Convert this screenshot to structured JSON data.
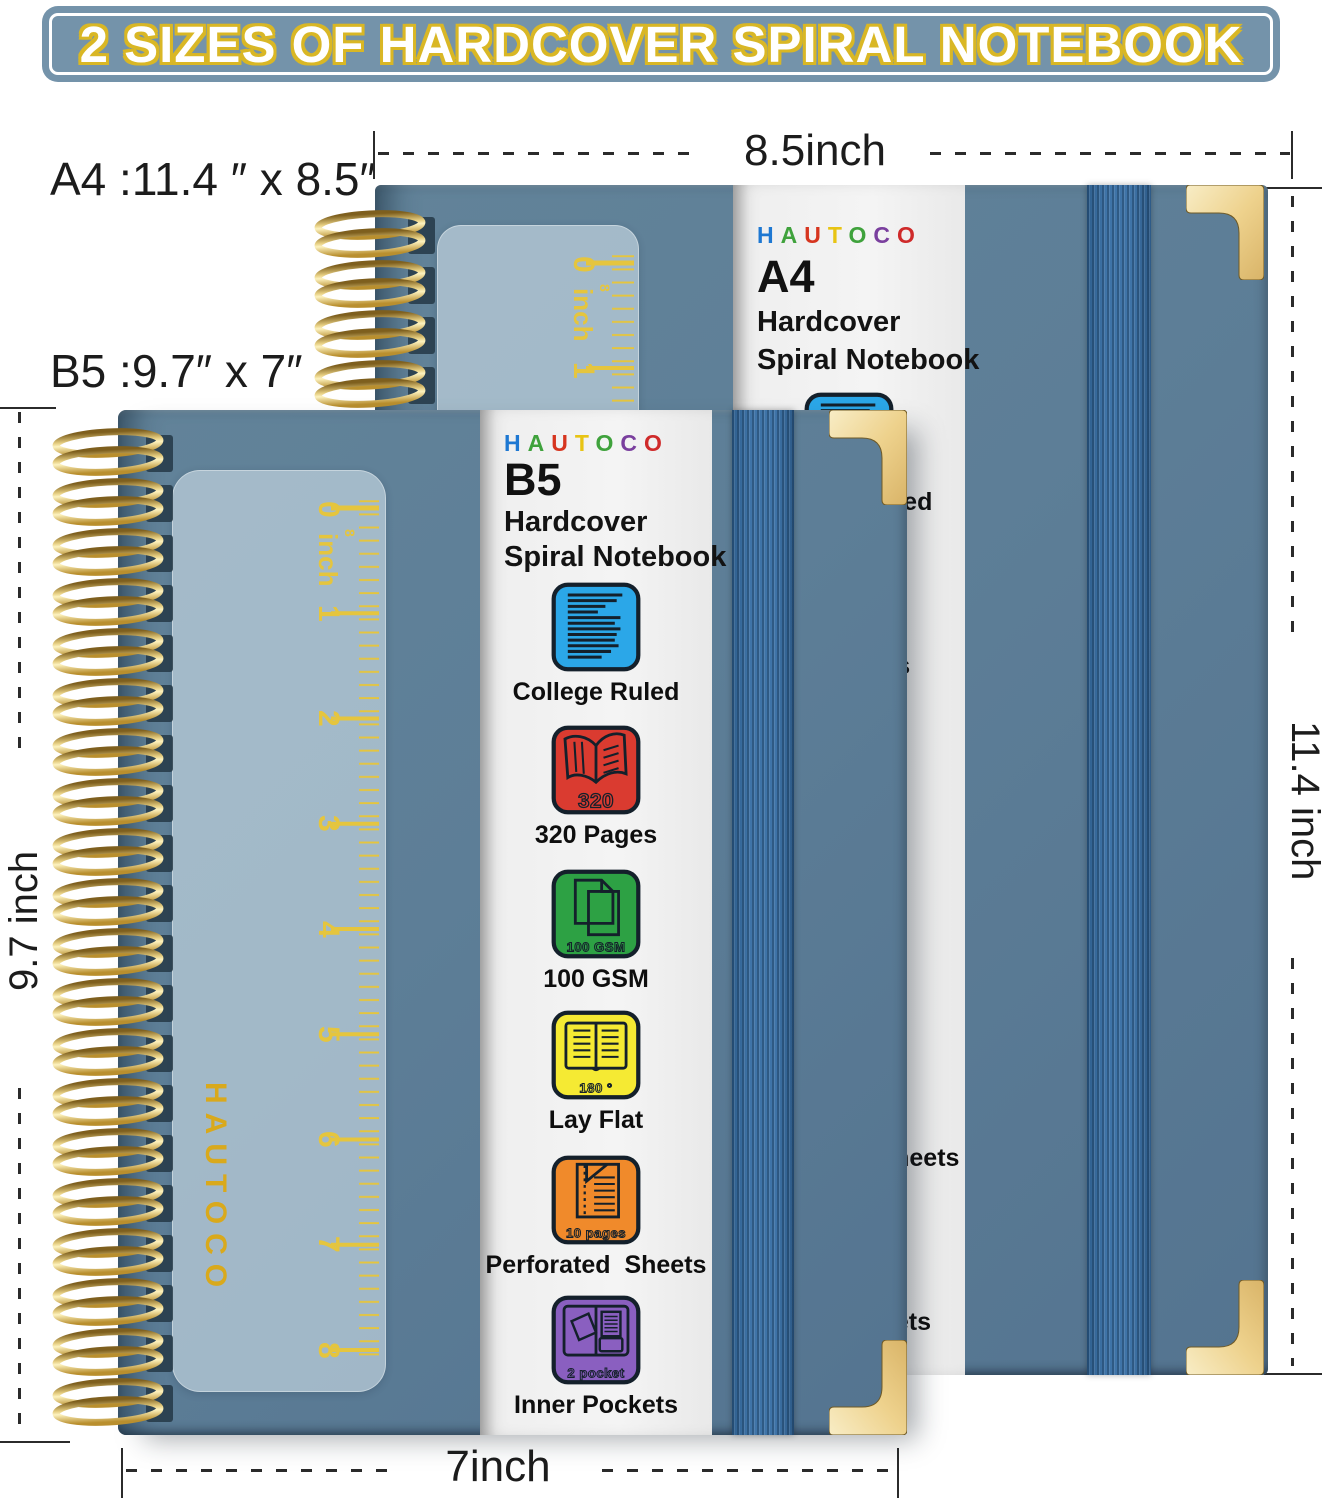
{
  "banner": {
    "title": "2 SIZES OF HARDCOVER SPIRAL NOTEBOOK"
  },
  "dims": {
    "a4_size_label": "A4 :11.4 ″ x 8.5″",
    "b5_size_label": "B5 :9.7″ x 7″",
    "top_width": "8.5inch",
    "right_height": "11.4 inch",
    "left_height": "9.7 inch",
    "bottom_width": "7inch"
  },
  "brand": {
    "name": "HAUTOCO",
    "cover_vertical": "HAUTOCO",
    "letters": [
      {
        "ch": "H",
        "style": "color:#1e78d2"
      },
      {
        "ch": "A",
        "style": "color:#3fa23c"
      },
      {
        "ch": "U",
        "style": "color:#d6351f"
      },
      {
        "ch": "T",
        "style": "color:#e8c414"
      },
      {
        "ch": "O",
        "style": "color:#3fa23c"
      },
      {
        "ch": "C",
        "style": "color:#7a3f9e"
      },
      {
        "ch": "O",
        "style": "color:#cf2a2a"
      }
    ]
  },
  "a4": {
    "size": "A4",
    "line1": "Hardcover",
    "line2": "Spiral Notebook"
  },
  "b5": {
    "size": "B5",
    "line1": "Hardcover",
    "line2": "Spiral Notebook"
  },
  "features": [
    {
      "caption": "College Ruled",
      "color": "#2ba7e8",
      "badge": ""
    },
    {
      "caption": "320 Pages",
      "color": "#da3b30",
      "badge": "320"
    },
    {
      "caption": "100 GSM",
      "color": "#2da144",
      "badge": "100 GSM"
    },
    {
      "caption": "Lay Flat",
      "color": "#f5ea33",
      "badge": "180 °"
    },
    {
      "caption": "Perforated  Sheets",
      "color": "#f08a2b",
      "badge": "10 pages"
    },
    {
      "caption": "Inner Pockets",
      "color": "#8a5fc0",
      "badge": "2 pocket"
    }
  ],
  "ruler": {
    "unit": "inch",
    "scale_mark": "8",
    "a4_marks": [
      "0",
      "1"
    ],
    "b5_marks": [
      "0",
      "1",
      "2",
      "3",
      "4",
      "5",
      "6",
      "7",
      "8"
    ]
  },
  "colors": {
    "cover": "#5d7e97",
    "band": "#3f74a8",
    "gold": "#d9b725",
    "banner_bg": "#7493aa",
    "strip_bg": "#f1f1f1"
  }
}
